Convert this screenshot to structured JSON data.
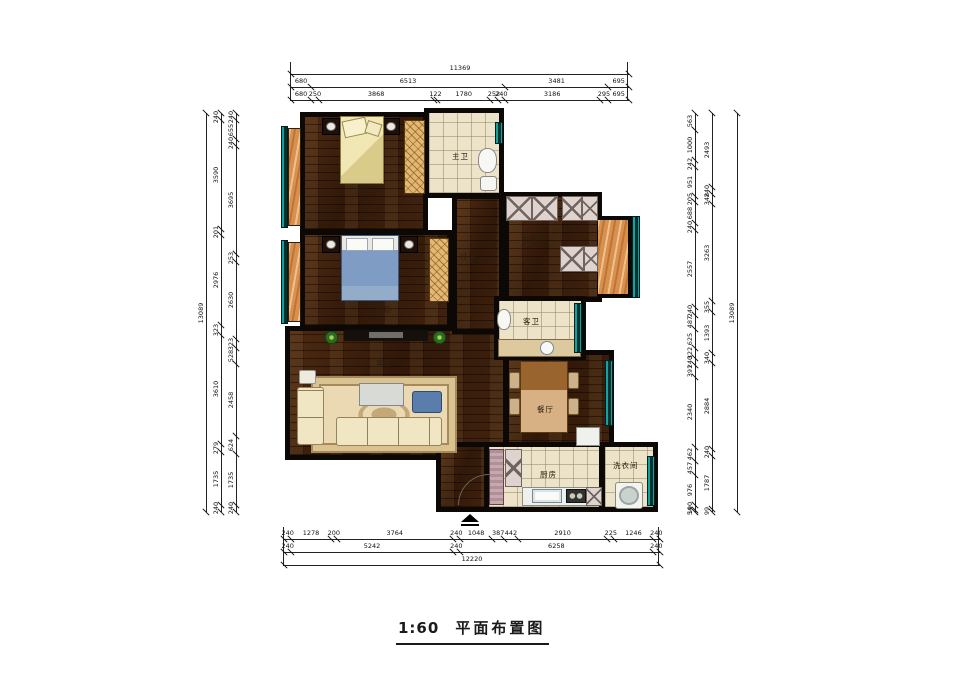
{
  "title": {
    "scale": "1:60",
    "name": "平面布置图"
  },
  "colors": {
    "wall": "#0c0805",
    "wood": "#40220e",
    "tile": "#ece3c8",
    "window_teal": "#0fa3a3",
    "balcony_orange": "#d8904f"
  },
  "plan": {
    "rooms": [
      {
        "id": "living-room",
        "label": "客厅",
        "floor": "wood",
        "x": 285,
        "y": 326,
        "w": 223,
        "h": 134,
        "label_at": [
          376,
          360
        ]
      },
      {
        "id": "dining-room",
        "label": "餐厅",
        "floor": "wood",
        "x": 504,
        "y": 350,
        "w": 110,
        "h": 104,
        "label_at": [
          537,
          406
        ]
      },
      {
        "id": "corridor",
        "label": "过道",
        "floor": "wood",
        "x": 452,
        "y": 194,
        "w": 52,
        "h": 140,
        "label_at": [
          460,
          253
        ]
      },
      {
        "id": "master-bedroom",
        "label": "主卧",
        "floor": "wood",
        "x": 300,
        "y": 112,
        "w": 128,
        "h": 122,
        "label_at": [
          355,
          187
        ]
      },
      {
        "id": "guest-bedroom",
        "label": "客卧",
        "floor": "wood",
        "x": 300,
        "y": 230,
        "w": 152,
        "h": 100,
        "label_at": [
          376,
          306
        ]
      },
      {
        "id": "cloakroom",
        "label": "衣帽间",
        "floor": "wood",
        "x": 504,
        "y": 192,
        "w": 98,
        "h": 110,
        "label_at": [
          521,
          236
        ]
      },
      {
        "id": "master-bath",
        "label": "主卫",
        "floor": "tile",
        "x": 424,
        "y": 108,
        "w": 80,
        "h": 90,
        "label_at": [
          452,
          153
        ]
      },
      {
        "id": "guest-bath",
        "label": "客卫",
        "floor": "tile",
        "x": 494,
        "y": 296,
        "w": 92,
        "h": 64,
        "label_at": [
          523,
          318
        ]
      },
      {
        "id": "entry",
        "label": "玄关",
        "floor": "wood",
        "x": 436,
        "y": 442,
        "w": 54,
        "h": 70,
        "label_at": [
          459,
          466
        ]
      },
      {
        "id": "kitchen",
        "label": "厨房",
        "floor": "tile",
        "x": 484,
        "y": 442,
        "w": 120,
        "h": 70,
        "label_at": [
          540,
          471
        ]
      },
      {
        "id": "laundry",
        "label": "洗衣间",
        "floor": "tile",
        "x": 600,
        "y": 442,
        "w": 58,
        "h": 70,
        "label_at": [
          613,
          462
        ]
      }
    ],
    "orange_areas": [
      {
        "id": "balcony-upper",
        "x": 288,
        "y": 128,
        "w": 13,
        "h": 98,
        "bay": false
      },
      {
        "id": "balcony-lower",
        "x": 288,
        "y": 242,
        "w": 13,
        "h": 80,
        "bay": false
      },
      {
        "id": "bay-window",
        "x": 598,
        "y": 216,
        "w": 34,
        "h": 82,
        "bay": true
      }
    ],
    "windows": [
      {
        "x": 281,
        "y": 126,
        "w": 7,
        "h": 102
      },
      {
        "x": 281,
        "y": 240,
        "w": 7,
        "h": 84
      },
      {
        "x": 495,
        "y": 122,
        "w": 8,
        "h": 22
      },
      {
        "x": 632,
        "y": 216,
        "w": 8,
        "h": 82
      },
      {
        "x": 574,
        "y": 303,
        "w": 8,
        "h": 50
      },
      {
        "x": 605,
        "y": 360,
        "w": 8,
        "h": 66
      },
      {
        "x": 647,
        "y": 456,
        "w": 8,
        "h": 50
      }
    ],
    "furniture": [
      {
        "t": "nightstand",
        "x": 322,
        "y": 118,
        "w": 18,
        "h": 17
      },
      {
        "t": "nightstand",
        "x": 382,
        "y": 118,
        "w": 18,
        "h": 17
      },
      {
        "t": "bed-v",
        "x": 340,
        "y": 116,
        "w": 44,
        "h": 68
      },
      {
        "t": "wardrobe",
        "x": 404,
        "y": 120,
        "w": 21,
        "h": 74
      },
      {
        "t": "toilet",
        "x": 478,
        "y": 148,
        "w": 19,
        "h": 25
      },
      {
        "t": "sink-sq",
        "x": 480,
        "y": 176,
        "w": 17,
        "h": 15
      },
      {
        "t": "nightstand",
        "x": 322,
        "y": 236,
        "w": 18,
        "h": 17
      },
      {
        "t": "nightstand",
        "x": 400,
        "y": 236,
        "w": 18,
        "h": 17
      },
      {
        "t": "bed-h",
        "x": 341,
        "y": 235,
        "w": 58,
        "h": 66
      },
      {
        "t": "wardrobe",
        "x": 429,
        "y": 238,
        "w": 20,
        "h": 64
      },
      {
        "t": "cab-x",
        "x": 506,
        "y": 196,
        "w": 26,
        "h": 25
      },
      {
        "t": "cab-x",
        "x": 532,
        "y": 196,
        "w": 26,
        "h": 25
      },
      {
        "t": "cab-x",
        "x": 562,
        "y": 196,
        "w": 20,
        "h": 25
      },
      {
        "t": "cab-x",
        "x": 582,
        "y": 196,
        "w": 16,
        "h": 25
      },
      {
        "t": "cab-x",
        "x": 560,
        "y": 246,
        "w": 24,
        "h": 26
      },
      {
        "t": "cab-x",
        "x": 584,
        "y": 246,
        "w": 14,
        "h": 26
      },
      {
        "t": "plant",
        "x": 323,
        "y": 329,
        "w": 17,
        "h": 17
      },
      {
        "t": "plant",
        "x": 431,
        "y": 329,
        "w": 17,
        "h": 17
      },
      {
        "t": "tv-cab",
        "x": 344,
        "y": 330,
        "w": 84,
        "h": 11
      },
      {
        "t": "rug",
        "x": 311,
        "y": 376,
        "w": 146,
        "h": 77
      },
      {
        "t": "coffee-table",
        "x": 359,
        "y": 383,
        "w": 45,
        "h": 23
      },
      {
        "t": "blue-chair",
        "x": 412,
        "y": 391,
        "w": 30,
        "h": 22
      },
      {
        "t": "sofa",
        "x": 336,
        "y": 417,
        "w": 106,
        "h": 29
      },
      {
        "t": "sofa-v",
        "x": 297,
        "y": 387,
        "w": 27,
        "h": 58
      },
      {
        "t": "side-table",
        "x": 299,
        "y": 370,
        "w": 17,
        "h": 14
      },
      {
        "t": "table-dining",
        "x": 520,
        "y": 361,
        "w": 48,
        "h": 72
      },
      {
        "t": "chair",
        "x": 509,
        "y": 372,
        "w": 11,
        "h": 17
      },
      {
        "t": "chair",
        "x": 509,
        "y": 398,
        "w": 11,
        "h": 17
      },
      {
        "t": "chair",
        "x": 568,
        "y": 372,
        "w": 11,
        "h": 17
      },
      {
        "t": "chair",
        "x": 568,
        "y": 398,
        "w": 11,
        "h": 17
      },
      {
        "t": "sideboard",
        "x": 576,
        "y": 427,
        "w": 24,
        "h": 19
      },
      {
        "t": "vanity",
        "x": 498,
        "y": 339,
        "w": 83,
        "h": 18
      },
      {
        "t": "sink-round",
        "x": 540,
        "y": 341,
        "w": 14,
        "h": 14
      },
      {
        "t": "toilet",
        "x": 497,
        "y": 309,
        "w": 14,
        "h": 21
      },
      {
        "t": "cab-stripe",
        "x": 489,
        "y": 449,
        "w": 15,
        "h": 56
      },
      {
        "t": "cab-x",
        "x": 505,
        "y": 449,
        "w": 17,
        "h": 38
      },
      {
        "t": "counter",
        "x": 522,
        "y": 487,
        "w": 80,
        "h": 19
      },
      {
        "t": "sink",
        "x": 532,
        "y": 489,
        "w": 30,
        "h": 14
      },
      {
        "t": "stove",
        "x": 566,
        "y": 489,
        "w": 20,
        "h": 14
      },
      {
        "t": "cab-x",
        "x": 586,
        "y": 487,
        "w": 16,
        "h": 19
      },
      {
        "t": "washer",
        "x": 615,
        "y": 482,
        "w": 28,
        "h": 27
      }
    ],
    "door_arc": {
      "x": 458,
      "y": 474,
      "s": 30
    },
    "entrance_marker": {
      "x": 461,
      "y": 514,
      "w": 18
    }
  },
  "dimensions": {
    "top": {
      "x": 290,
      "y": 62,
      "len": 338,
      "rows": [
        {
          "segs": [
            "11369"
          ]
        },
        {
          "segs": [
            "680",
            "6513",
            "3481",
            "695"
          ]
        },
        {
          "segs": [
            "680",
            "250",
            "3868",
            "122",
            "1780",
            "252",
            "240",
            "3186",
            "295",
            "695"
          ]
        }
      ]
    },
    "bottom": {
      "x": 283,
      "y": 527,
      "len": 376,
      "rows": [
        {
          "segs": [
            "240",
            "1278",
            "200",
            "3764",
            "240",
            "1048",
            "387",
            "442",
            "2910",
            "225",
            "1246",
            "240"
          ]
        },
        {
          "segs": [
            "240",
            "5242",
            "240",
            "6258",
            "240"
          ]
        },
        {
          "segs": [
            "12220"
          ]
        }
      ]
    },
    "left": {
      "y": 113,
      "len": 399,
      "cols": [
        {
          "x": 206,
          "segs": [
            "13089"
          ]
        },
        {
          "x": 221,
          "segs": [
            "240",
            "3590",
            "201",
            "2976",
            "323",
            "3610",
            "279",
            "1735",
            "240"
          ]
        },
        {
          "x": 236,
          "segs": [
            "240",
            "655",
            "240",
            "3695",
            "253",
            "2630",
            "323",
            "528",
            "2458",
            "624",
            "1735",
            "240"
          ]
        }
      ]
    },
    "right": {
      "y": 113,
      "len": 399,
      "cols": [
        {
          "x": 695,
          "segs": [
            "563",
            "1000",
            "242",
            "951",
            "205",
            "688",
            "240",
            "2557",
            "240",
            "487",
            "625",
            "322",
            "240",
            "391",
            "2340",
            "462",
            "457",
            "976",
            "190",
            "54"
          ]
        },
        {
          "x": 712,
          "segs": [
            "2493",
            "240",
            "348",
            "3263",
            "355",
            "1393",
            "340",
            "2884",
            "240",
            "1787",
            "99"
          ]
        },
        {
          "x": 737,
          "segs": [
            "13089"
          ]
        }
      ]
    }
  }
}
